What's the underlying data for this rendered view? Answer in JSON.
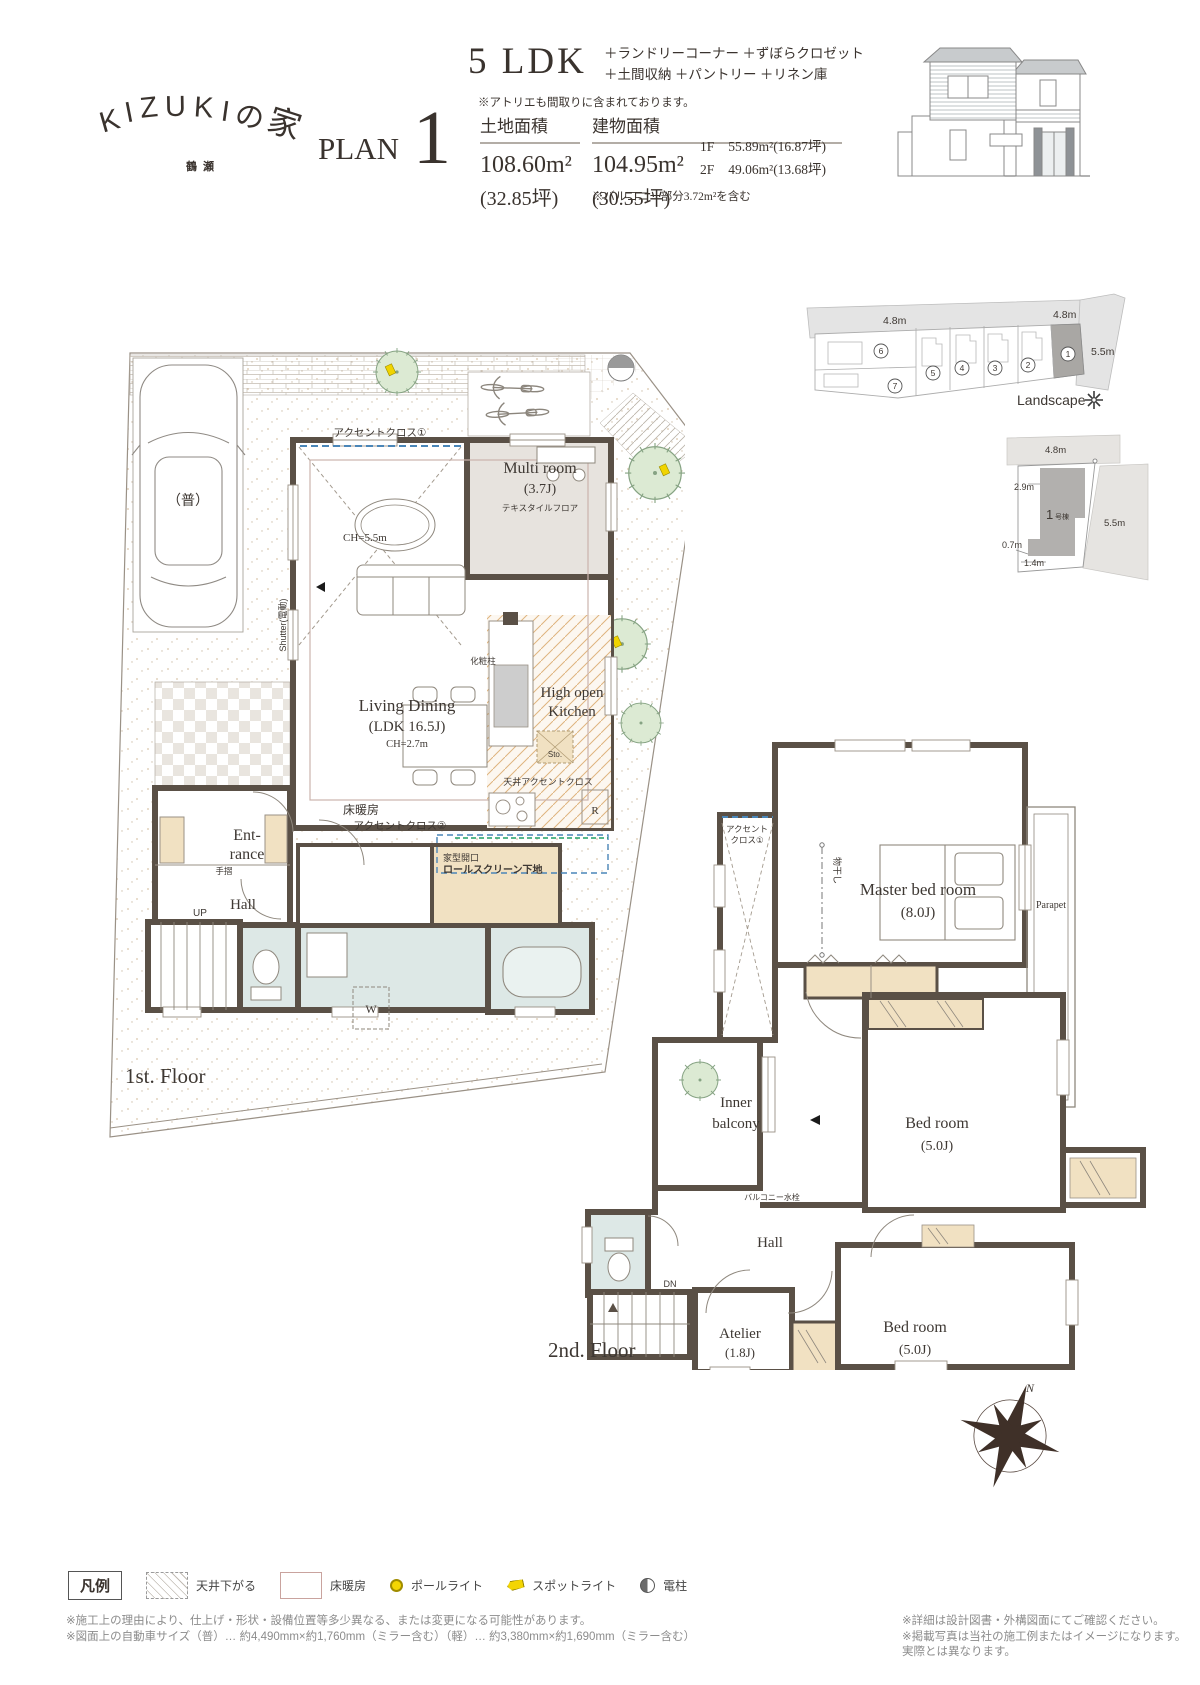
{
  "header": {
    "logo": {
      "letters": [
        "K",
        "I",
        "Z",
        "U",
        "K",
        "I",
        "の",
        "家"
      ],
      "sub": "鶴瀬"
    },
    "plan": {
      "label": "PLAN",
      "number": "1"
    },
    "type": {
      "ldk": "5 LDK",
      "features_line1": "＋ランドリーコーナー ＋ずぼらクロゼット",
      "features_line2": "＋土間収納 ＋パントリー ＋リネン庫",
      "note": "※アトリエも間取りに含まれております。"
    },
    "land": {
      "label": "土地面積",
      "value": "108.60m²",
      "tsubo": "(32.85坪)"
    },
    "building": {
      "label": "建物面積",
      "value": "104.95m²",
      "tsubo": "(30.55坪)",
      "f1_label": "1F",
      "f1_value": "55.89m²(16.87坪)",
      "f2_label": "2F",
      "f2_value": "49.06m²(13.68坪)",
      "balcony_note": "※バルコニー部分3.72m²を含む"
    }
  },
  "site_plan": {
    "road_left": "4.8m",
    "road_right": "4.8m",
    "road_side": "5.5m",
    "landscape": "Landscape",
    "lots": [
      "1",
      "2",
      "3",
      "4",
      "5",
      "6",
      "7"
    ]
  },
  "lot_detail": {
    "road_top": "4.8m",
    "dim_left": "2.9m",
    "dim_right": "5.5m",
    "dim_bottom_left": "0.7m",
    "dim_bottom": "1.4m",
    "building_num": "1",
    "building_suffix": "号棟"
  },
  "floor1": {
    "title": "1st. Floor",
    "labels": {
      "accent1": "アクセントクロス①",
      "ch_void": "CH=5.5m",
      "shutter": "Shutter(電動)",
      "multi": "Multi room",
      "multi_size": "(3.7J)",
      "multi_floor": "テキスタイルフロア",
      "living": "Living Dining",
      "living_size": "(LDK 16.5J)",
      "living_ch": "CH=2.7m",
      "kitchen1": "High open",
      "kitchen2": "Kitchen",
      "pillar": "化粧柱",
      "sto": "Sto.",
      "ceiling_accent": "天井アクセントクロス",
      "fridge": "R",
      "floor_heating": "床暖房",
      "accent2": "アクセントクロス②",
      "opening": "家型開口",
      "rollscreen": "ロールスクリーン下地",
      "ent1": "Ent-",
      "ent2": "rance",
      "handrail": "手摺",
      "hall": "Hall",
      "up": "UP",
      "washer": "W",
      "car": "（普）"
    }
  },
  "floor2": {
    "title": "2nd. Floor",
    "labels": {
      "accent1a": "アクセント",
      "accent1b": "クロス①",
      "drying": "物干し",
      "master": "Master bed room",
      "master_size": "(8.0J)",
      "parapet": "Parapet",
      "inner1": "Inner",
      "inner2": "balcony",
      "bed1": "Bed room",
      "bed1_size": "(5.0J)",
      "faucet": "バルコニー水栓",
      "hall": "Hall",
      "dn": "DN",
      "atelier": "Atelier",
      "atelier_size": "(1.8J)",
      "bed2": "Bed room",
      "bed2_size": "(5.0J)"
    }
  },
  "compass": {
    "north": "N"
  },
  "legend": {
    "title": "凡例",
    "ceiling": "天井下がる",
    "floor_heating": "床暖房",
    "pole_light": "ポールライト",
    "spot_light": "スポットライト",
    "utility_pole": "電柱"
  },
  "footnotes": {
    "left1": "※施工上の理由により、仕上げ・形状・設備位置等多少異なる、または変更になる可能性があります。",
    "left2": "※図面上の自動車サイズ（普）… 約4,490mm×約1,760mm（ミラー含む）（軽）… 約3,380mm×約1,690mm（ミラー含む）",
    "right1": "※詳細は設計図書・外構図面にてご確認ください。",
    "right2": "※掲載写真は当社の施工例またはイメージになります。実際とは異なります。"
  }
}
